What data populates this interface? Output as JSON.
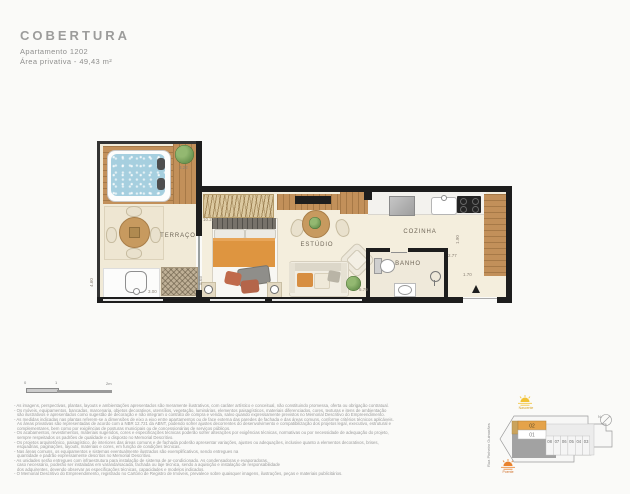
{
  "colors": {
    "wall": "#1d1d1d",
    "floor_cream": "#f4eedd",
    "wood": "#c2905a",
    "water_blue": "#a6cfdf",
    "accent_orange": "#e5a34a",
    "sun_yellow": "#f2c234",
    "sun_orange": "#e8822e",
    "text_gray": "#8f8f8e"
  },
  "header": {
    "title": "COBERTURA",
    "apartment": "Apartamento 1202",
    "private_area": "Área privativa - 49,43 m²"
  },
  "plan": {
    "rooms": {
      "terrace": "TERRAÇO",
      "studio": "ESTÚDIO",
      "kitchen": "COZINHA",
      "bathroom": "BANHO"
    },
    "dimensions": {
      "deck": "3.22",
      "terrace_depth": "4.60",
      "terrace_width": "3.00",
      "studio_length": "10.27",
      "studio_depth": "5.03",
      "studio_width": "5.79",
      "kitchen_depth": "1.90",
      "hall_width": "2.77",
      "entry_width": "1.70"
    }
  },
  "scalebar": {
    "tick0": "0",
    "tick1": "1",
    "tick2": "2m"
  },
  "siteplan": {
    "street": "Rua Pinheiro Guimarães",
    "north_label": "N",
    "sun_east_label": "Nascente",
    "sun_west_label": "Poente",
    "unit_01": "01",
    "unit_02": "02",
    "units_row": [
      "08",
      "07",
      "06",
      "05",
      "04",
      "03"
    ],
    "highlighted_unit": "02"
  },
  "disclaimer": {
    "lines": [
      "- As imagens, perspectivas, plantas, layouts e ambientações apresentados são meramente ilustrativos, com caráter artístico e conceitual, não constituindo promessa, oferta ou obrigação contratual.",
      "- Os móveis, equipamentos, bancadas, marcenaria, objetos decorativos, utensílios, vegetação, luminárias, elementos paisagísticos, materiais diferenciados, cores, texturas e itens de ambientação",
      "são ilustrativos e apresentados como sugestão de decoração e não integram o contrato de compra e venda, salvo quando expressamente previstos no Memorial Descritivo do Empreendimento.",
      "- As medidas indicadas nas plantas referem-se a dimensões de eixo a eixo entre apartamentos ou de face externa das paredes de fachada e das áreas comuns, conforme critérios técnicos aplicáveis.",
      "As áreas privativas são representadas de acordo com a NBR 12.721 da ABNT, podendo sofrer ajustes decorrentes do desenvolvimento e compatibilização dos projetos legal, executivo, estrutural e",
      "complementares, bem como por exigências de posturas municipais ou de concessionárias de serviços públicos.",
      "- Os acabamentos, revestimentos, materiais sugeridos, cores e especificações técnicas poderão sofrer alterações por exigências técnicas, normativas ou por necessidade de adequação do projeto,",
      "sempre respeitados os padrões de qualidade e o disposto no Memorial Descritivo.",
      "- Os projetos arquitetônico, paisagístico, de interiores das áreas comuns e de fachada poderão apresentar variações, ajustes ou adequações, inclusive quanto a elementos decorativos, brises,",
      "esquadrias, paginações, layouts, materiais e cores, em função de condições técnicas.",
      "- Nas áreas comuns, os equipamentos e sistemas eventualmente ilustrados são exemplificativos, sendo entregues na",
      "quantidade e padrão expressamente descritos no Memorial Descritivo.",
      "- As unidades serão entregues com infraestrutura para instalação de sistema de ar-condicionado. As condensadoras e evaporadoras,",
      "caso necessário, poderão ser instaladas em varanda/sacada, fachada ou laje técnica, sendo a aquisição e instalação de responsabilidade",
      "dos adquirentes, devendo observar as especificações técnicas, capacidades e modelos indicados.",
      "- O Memorial Descritivo do Empreendimento, registrado no Cartório de Registro de Imóveis, prevalece sobre quaisquer imagens, ilustrações, peças e materiais publicitários."
    ]
  }
}
